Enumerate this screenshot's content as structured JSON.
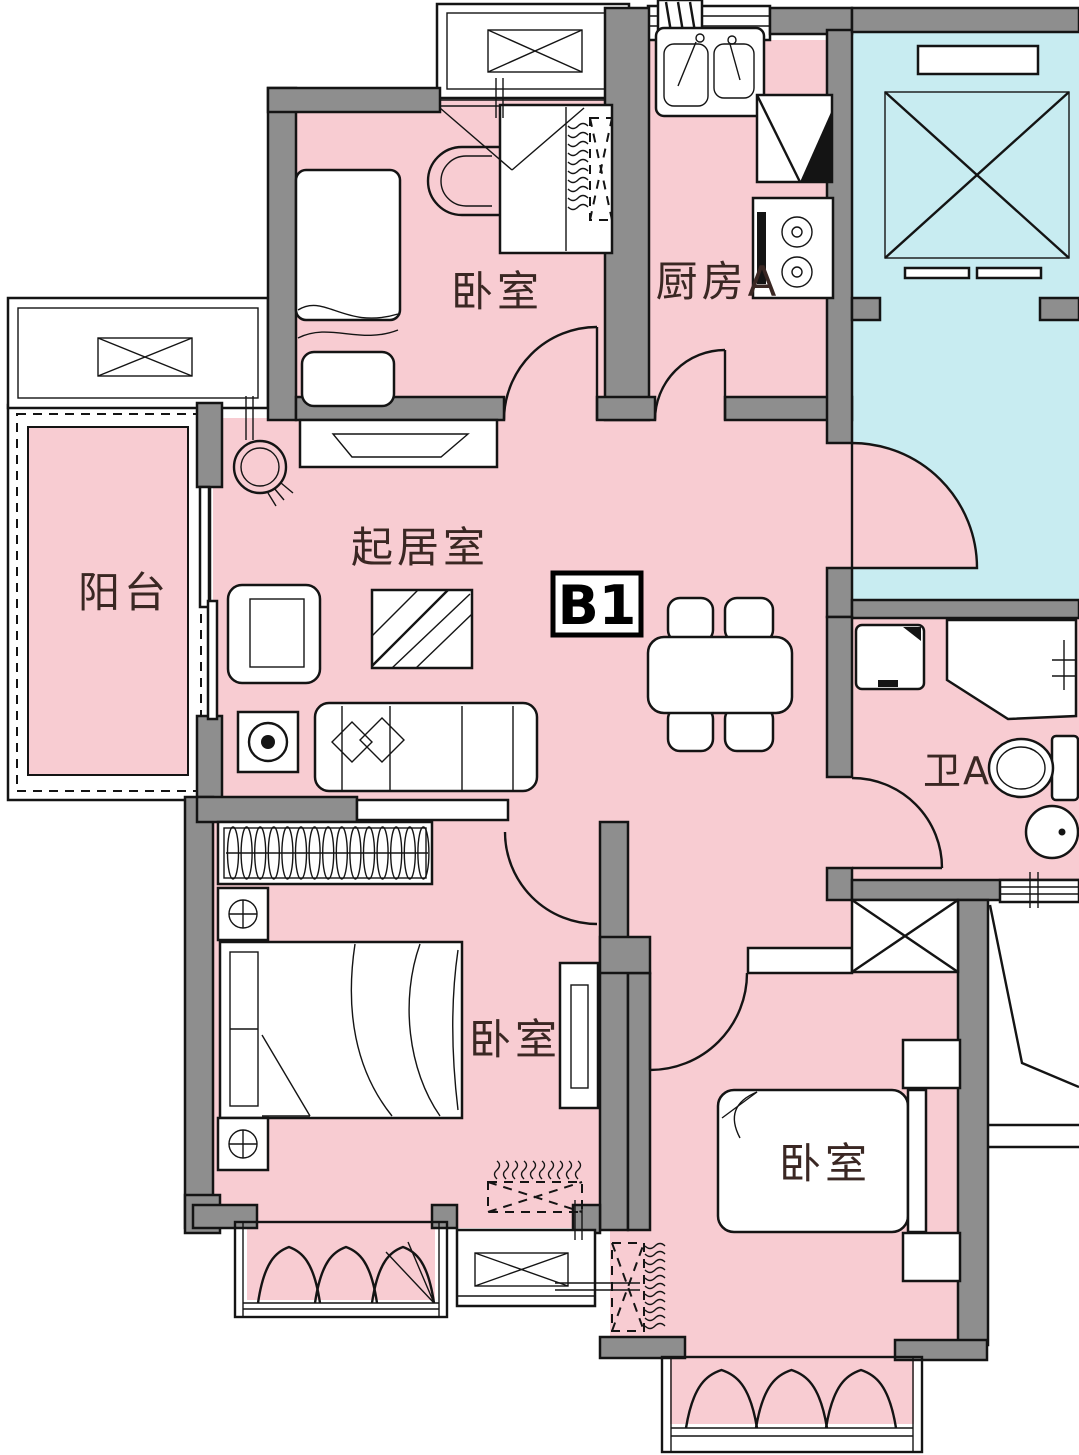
{
  "unit_badge": {
    "label": "B1"
  },
  "rooms": {
    "bedroom_top": {
      "label": "卧室"
    },
    "kitchen": {
      "label": "厨房A"
    },
    "living_room": {
      "label": "起居室"
    },
    "balcony": {
      "label": "阳台"
    },
    "bathroom": {
      "label": "卫A"
    },
    "bedroom_left": {
      "label": "卧室"
    },
    "bedroom_right": {
      "label": "卧室"
    }
  },
  "colors": {
    "room_fill": "#f8ccd2",
    "public_fill": "#c8ecf1",
    "wall_fill": "#8e8e8e",
    "line": "#141414",
    "label_color": "#3a2723",
    "background": "#ffffff"
  }
}
